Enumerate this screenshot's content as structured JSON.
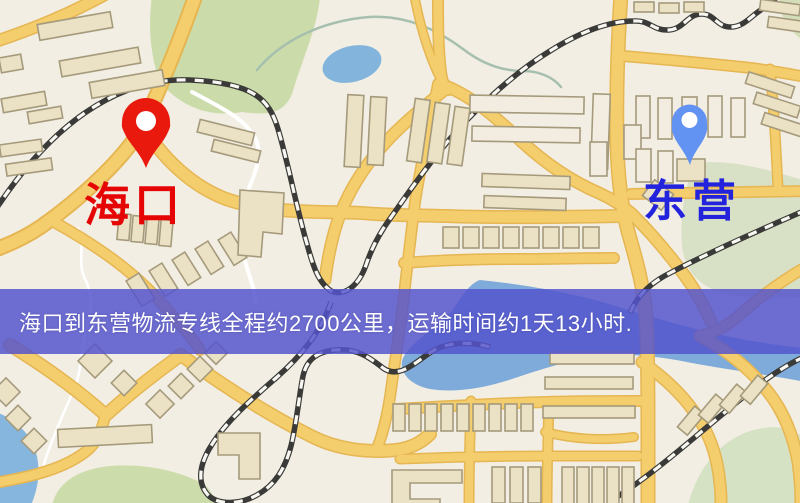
{
  "map": {
    "origin_marker": {
      "label": "海口",
      "label_color": "#e60505",
      "pin_color": "#e9190d"
    },
    "destination_marker": {
      "label": "东营",
      "label_color": "#2323dd",
      "pin_color": "#6292f2"
    },
    "info_banner": {
      "text": "海口到东营物流专线全程约2700公里，运输时间约1天13小时.",
      "distance_km": "2700",
      "duration": "1天13小时",
      "background_color": "#5454cd",
      "text_color": "#ffffff"
    },
    "palette": {
      "map_background": "#f2eee3",
      "road_yellow": "#f4cd6d",
      "road_casing": "#e5b652",
      "building_fill": "#ebe1c4",
      "building_stroke": "#a59a7c",
      "park_green": "#cbdcaa",
      "sage_green": "#d8e1c5",
      "water_blue": "#82b4dc",
      "railway_dark": "#3a3a38",
      "railway_light": "#f8f7f1"
    }
  }
}
